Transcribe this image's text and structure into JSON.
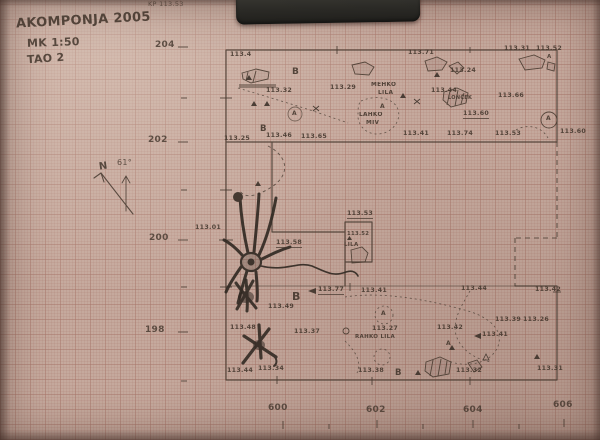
{
  "header": {
    "site_year": "AKOMPONJA 2005",
    "scale": "MK 1:50",
    "trench": "TAO 2",
    "corner_note": "KP 113.53"
  },
  "north_arrow": {
    "label": "N",
    "angle": "61°"
  },
  "colors": {
    "paper": "#c5a99d",
    "grid_line": "#a8766a",
    "pencil_ink": "#43362c",
    "clip_tab": "#2a2a25"
  },
  "axes": {
    "left_unit": "northing (m)",
    "bottom_unit": "easting (m)",
    "left": [
      {
        "text": "204",
        "x": 155,
        "y": 41
      },
      {
        "text": "202",
        "x": 148,
        "y": 136
      },
      {
        "text": "200",
        "x": 149,
        "y": 234
      },
      {
        "text": "198",
        "x": 145,
        "y": 326
      }
    ],
    "bottom": [
      {
        "text": "600",
        "x": 268,
        "y": 404
      },
      {
        "text": "602",
        "x": 366,
        "y": 406
      },
      {
        "text": "604",
        "x": 463,
        "y": 406
      },
      {
        "text": "606",
        "x": 553,
        "y": 401
      }
    ]
  },
  "plan": {
    "labels": [
      {
        "text": "113.4",
        "x": 230,
        "y": 52
      },
      {
        "text": "B",
        "x": 292,
        "y": 68,
        "size": 9
      },
      {
        "text": "113.32",
        "x": 266,
        "y": 88
      },
      {
        "text": "113.29",
        "x": 330,
        "y": 85
      },
      {
        "text": "113.71",
        "x": 408,
        "y": 50
      },
      {
        "text": "113.31",
        "x": 504,
        "y": 46
      },
      {
        "text": "113.52",
        "x": 536,
        "y": 46
      },
      {
        "text": "A",
        "x": 547,
        "y": 55,
        "size": 5.5
      },
      {
        "text": "113.24",
        "x": 450,
        "y": 68
      },
      {
        "text": "113.44",
        "x": 431,
        "y": 88
      },
      {
        "text": "MEHKO",
        "x": 371,
        "y": 83,
        "size": 5.8
      },
      {
        "text": "LILA",
        "x": 378,
        "y": 91,
        "size": 5.8
      },
      {
        "text": "LONČEK",
        "x": 448,
        "y": 96,
        "size": 5
      },
      {
        "text": "LAHKO",
        "x": 359,
        "y": 113,
        "size": 5.8
      },
      {
        "text": "MIV",
        "x": 366,
        "y": 121,
        "size": 5.8
      },
      {
        "text": "113.66",
        "x": 498,
        "y": 93
      },
      {
        "text": "113.60",
        "x": 463,
        "y": 111,
        "u": 1
      },
      {
        "text": "A",
        "x": 292,
        "y": 111,
        "size": 6
      },
      {
        "text": "A",
        "x": 380,
        "y": 104,
        "size": 6
      },
      {
        "text": "B",
        "x": 260,
        "y": 125,
        "size": 8.5
      },
      {
        "text": "113.46",
        "x": 266,
        "y": 133
      },
      {
        "text": "113.65",
        "x": 301,
        "y": 134
      },
      {
        "text": "113.41",
        "x": 403,
        "y": 131
      },
      {
        "text": "113.74",
        "x": 447,
        "y": 131
      },
      {
        "text": "113.53",
        "x": 495,
        "y": 131
      },
      {
        "text": "113.60",
        "x": 560,
        "y": 129
      },
      {
        "text": "113.25",
        "x": 224,
        "y": 136
      },
      {
        "text": "A",
        "x": 546,
        "y": 116,
        "size": 6
      },
      {
        "text": "113.01",
        "x": 195,
        "y": 225
      },
      {
        "text": "113.58",
        "x": 276,
        "y": 240,
        "u": 1
      },
      {
        "text": "113.53",
        "x": 347,
        "y": 211,
        "u": 1
      },
      {
        "text": "113.52",
        "x": 347,
        "y": 232,
        "size": 5.3
      },
      {
        "text": "LILA",
        "x": 344,
        "y": 243,
        "size": 5.5
      },
      {
        "text": "113.77",
        "x": 318,
        "y": 287,
        "u": 1
      },
      {
        "text": "B",
        "x": 292,
        "y": 291,
        "size": 11
      },
      {
        "text": "113.49",
        "x": 268,
        "y": 304
      },
      {
        "text": "113.48",
        "x": 230,
        "y": 325
      },
      {
        "text": "113.37",
        "x": 294,
        "y": 329
      },
      {
        "text": "113.41",
        "x": 361,
        "y": 288
      },
      {
        "text": "113.27",
        "x": 372,
        "y": 326
      },
      {
        "text": "RAHKO LILA",
        "x": 355,
        "y": 335,
        "size": 5.5
      },
      {
        "text": "A",
        "x": 381,
        "y": 311,
        "size": 6
      },
      {
        "text": "113.42",
        "x": 437,
        "y": 325
      },
      {
        "text": "A",
        "x": 446,
        "y": 341,
        "size": 6
      },
      {
        "text": "113.44",
        "x": 461,
        "y": 286
      },
      {
        "text": "113.42",
        "x": 535,
        "y": 287
      },
      {
        "text": "113.39",
        "x": 495,
        "y": 317
      },
      {
        "text": "113.26",
        "x": 523,
        "y": 317
      },
      {
        "text": "113.41",
        "x": 482,
        "y": 332
      },
      {
        "text": "113.44",
        "x": 227,
        "y": 368
      },
      {
        "text": "113.34",
        "x": 258,
        "y": 366
      },
      {
        "text": "113.38",
        "x": 358,
        "y": 368
      },
      {
        "text": "B",
        "x": 395,
        "y": 369,
        "size": 8.5
      },
      {
        "text": "113.32",
        "x": 456,
        "y": 368
      },
      {
        "text": "113.31",
        "x": 537,
        "y": 366
      }
    ]
  }
}
